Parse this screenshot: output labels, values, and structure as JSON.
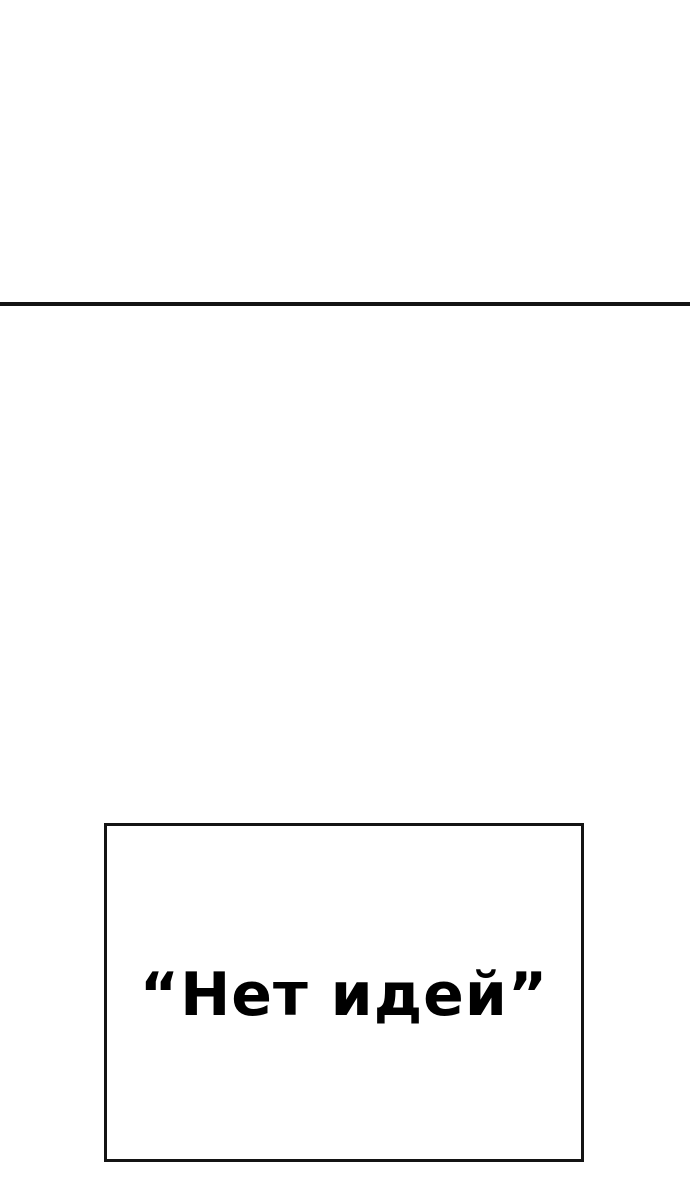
{
  "page": {
    "background_color": "#ffffff"
  },
  "top_panel": {
    "divider_color": "#141414"
  },
  "quote_panel": {
    "border_color": "#141414",
    "text_color": "#000000",
    "text": "“Нет идей”"
  }
}
